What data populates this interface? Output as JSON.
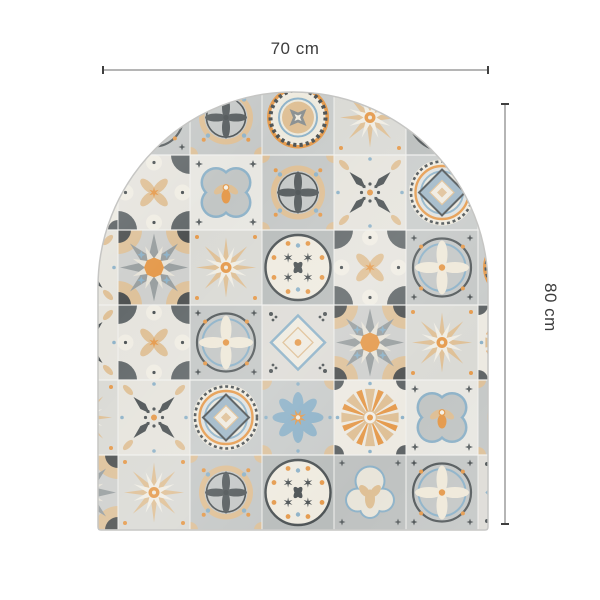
{
  "product": {
    "description_label": "arched azulejo tile mat"
  },
  "dimensions": {
    "width_label": "70 cm",
    "height_label": "80 cm"
  },
  "annotation_colors": {
    "line_gray": "#b5b5b5",
    "tick_dark": "#3f3f3f",
    "text_dark": "#3c3c3c"
  },
  "shape": {
    "left": 98,
    "right": 488,
    "bottom": 530,
    "apex": 92,
    "arc_center_y": 287,
    "radius": 195,
    "outline": "#c6c6c4"
  },
  "palette": {
    "cream": "#efebe0",
    "cream2": "#e8e4d9",
    "white_tile": "#f0ede4",
    "light": "#dadad5",
    "gray1": "#c5c8c7",
    "gray2": "#b9bdbc",
    "gray3": "#9aa0a1",
    "gray4": "#8d9293",
    "dark": "#4e5456",
    "dark2": "#5d6365",
    "blue": "#8fb3c9",
    "blue2": "#a9c4d6",
    "orange": "#e59b4e",
    "tan": "#dfc096",
    "grout": "#f2f2ef"
  },
  "mosaic": {
    "grid": {
      "cols": 7,
      "rows": 6,
      "cell_w": 72,
      "cell_h": 75,
      "origin_x": 46,
      "origin_y": 80
    },
    "map": [
      [
        "star8_dense",
        "flower_cross_circle",
        "petal_circle",
        "medallion_gear",
        "star8_light",
        "circle_dots",
        "star8_dense"
      ],
      [
        "rays_flower",
        "corner_fans",
        "quatrefoil_bee",
        "petal_circle",
        "arrow_cross",
        "target_diamond",
        "star8_light"
      ],
      [
        "arrow_cross",
        "star8_dense",
        "star8_light",
        "circle_dots",
        "corner_fans",
        "flower_cross_circle",
        "medallion_gear"
      ],
      [
        "arrow_cross",
        "corner_fans",
        "flower_cross_circle",
        "diamond_white",
        "star8_dense",
        "star8_light",
        "rays_flower"
      ],
      [
        "star8_light",
        "arrow_cross",
        "target_diamond",
        "blue_flower",
        "rays_flower",
        "quatrefoil_bee",
        "petal_circle"
      ],
      [
        "star8_dense",
        "star8_light",
        "petal_circle",
        "circle_dots",
        "lobed_arch",
        "flower_cross_circle",
        "diamond_white"
      ]
    ]
  }
}
